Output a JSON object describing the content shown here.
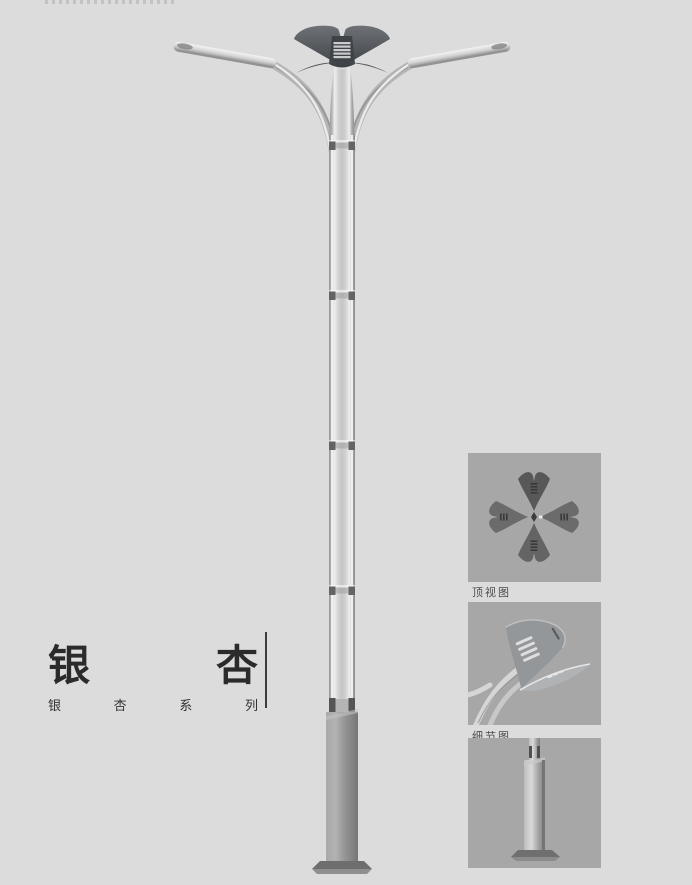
{
  "title": {
    "chars": [
      "银",
      "杏"
    ],
    "series": [
      "银",
      "杏",
      "系",
      "列"
    ]
  },
  "detail_labels": [
    "顶视图",
    "细节图"
  ],
  "illustrations": {
    "main": "ginkgo-streetlamp-two-arm-rendering",
    "thumb1": "lamp-head-top-view-four-leaves",
    "thumb2": "ginkgo-leaf-lamp-head-closeup",
    "thumb3": "square-pole-base-plate"
  },
  "colors": {
    "page_bg": "#dcdcdc",
    "tile_bg": "#a7a7a7",
    "metal_light": "#e8e8e8",
    "metal_mid": "#c0c0c0",
    "metal_dark": "#8c8c8c",
    "head_dark": "#44484c",
    "base_dark": "#8a8a8a",
    "title_text": "#2b2b2b",
    "label_text": "#4c4c4c"
  }
}
